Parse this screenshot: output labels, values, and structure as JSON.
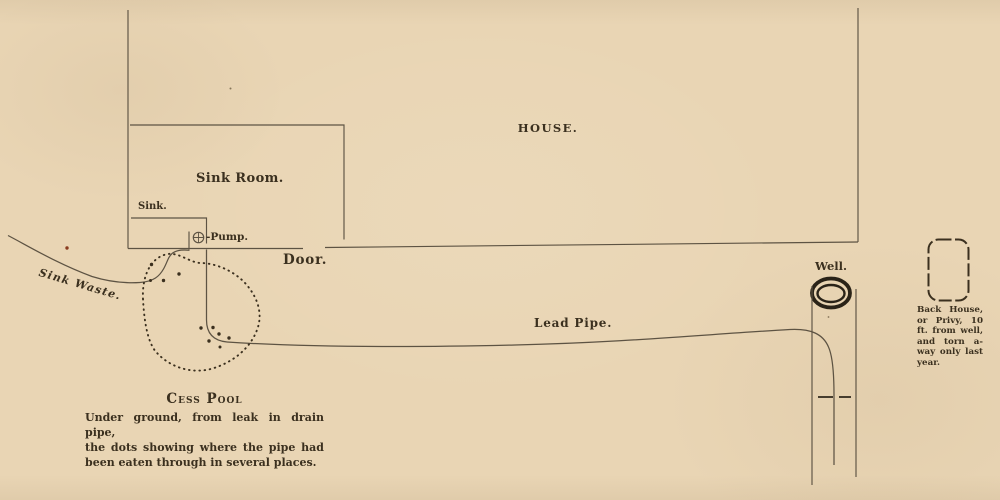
{
  "labels": {
    "house": "HOUSE.",
    "sink_room": "Sink Room.",
    "sink": "Sink.",
    "pump": "-Pump.",
    "door": "Door.",
    "sink_waste": "Sink Waste.",
    "lead_pipe": "Lead Pipe.",
    "well": "Well."
  },
  "cess_pool": {
    "title": "Cess Pool",
    "caption_lines": [
      "Under ground, from leak in drain pipe,",
      "the dots showing where the pipe had",
      "been eaten through in several places."
    ]
  },
  "back_house": {
    "lines": [
      "Back House,",
      "or Privy, 10",
      "ft. from well,",
      "and torn a-",
      "way only last",
      "year."
    ]
  },
  "colors": {
    "paper": "#e9d5b4",
    "ink": "#3b301f",
    "line": "#5d5343",
    "well_ink": "#2a2318",
    "speck_red": "#8a3c20",
    "speck_dim": "#85755a"
  }
}
